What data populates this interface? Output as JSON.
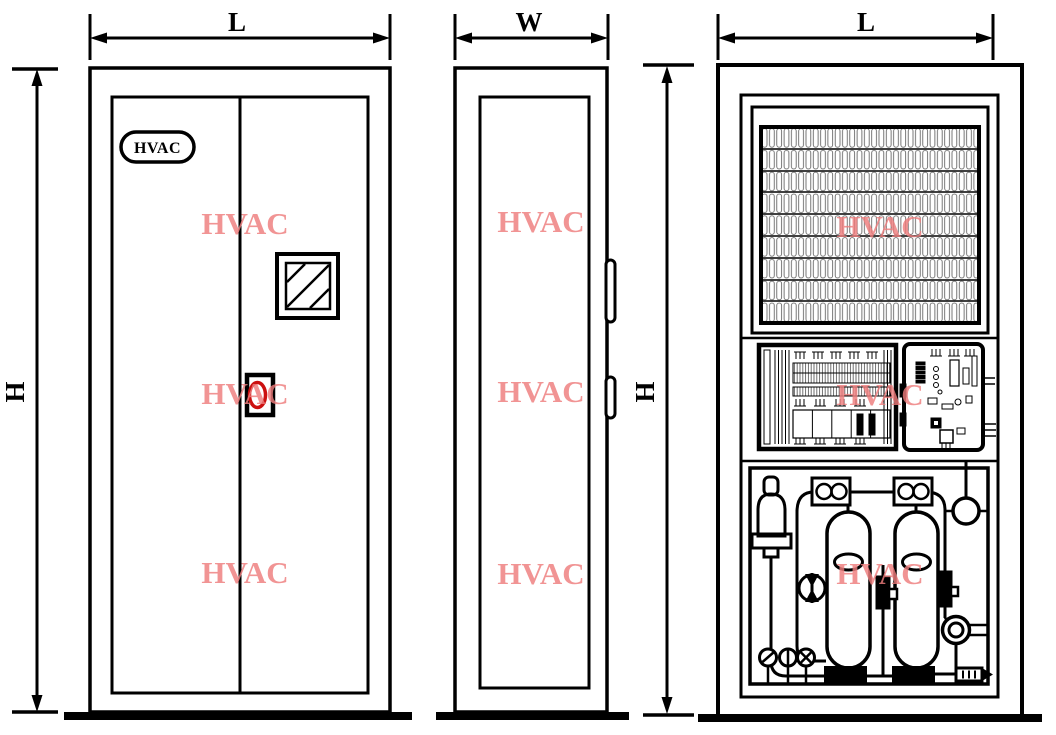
{
  "dimensions": {
    "front_width": "L",
    "side_width": "W",
    "internal_width": "L",
    "front_height": "H",
    "internal_height": "H"
  },
  "logo": {
    "text": "HVAC"
  },
  "watermark": {
    "text": "HVAC",
    "color": "#ee7d7d"
  },
  "colors": {
    "line": "#000000",
    "handle_accent": "#cc1010",
    "fin_texture": "#555555",
    "background": "#ffffff"
  }
}
